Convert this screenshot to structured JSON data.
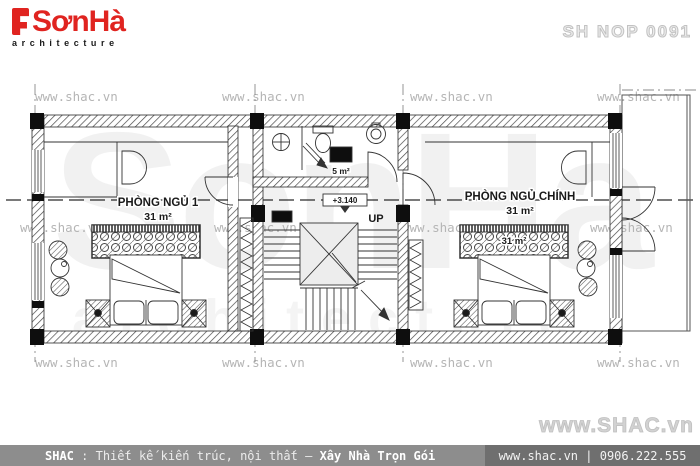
{
  "header": {
    "brand": "SơnHà",
    "brand_sub": "architecture",
    "drawing_code": "SH NOP 0091"
  },
  "watermarks": {
    "small": "www.shac.vn",
    "large": "www.SHAC.vn",
    "bg_brand": "SonHa",
    "bg_sub": "architecture"
  },
  "plan": {
    "rooms": [
      {
        "name": "PHÒNG NGỦ 1",
        "area": "31 m²"
      },
      {
        "name": "PHÒNG NGỦ CHÍNH",
        "area": "31 m²"
      }
    ],
    "bathroom": {
      "area": "5 m²"
    },
    "stair_label": "UP",
    "level_marker": "+3.140",
    "headboard_area_label": "31 m²"
  },
  "footer": {
    "brand": "SHAC",
    "separator": " : ",
    "services": "Thiết kế kiến trúc, nội thất",
    "dash": " – ",
    "tagline": "Xây Nhà Trọn Gói",
    "website": "www.shac.vn",
    "divider": " | ",
    "phone": "0906.222.555"
  },
  "colors": {
    "brand_red": "#e02420",
    "footer_left_bg": "#8d8d8d",
    "footer_right_bg": "#6f6f6f",
    "watermark_gray": "#b5b5b5"
  }
}
